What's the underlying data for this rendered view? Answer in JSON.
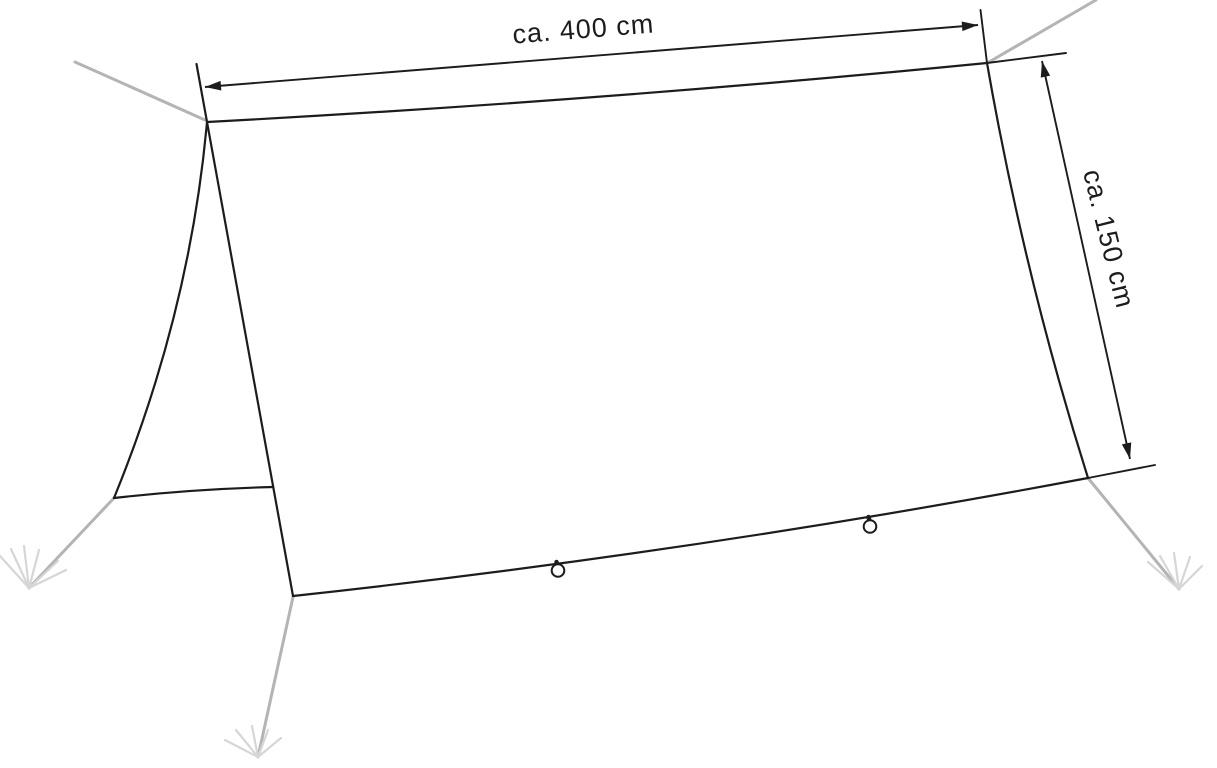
{
  "diagram": {
    "title": "Tarp dimension line drawing",
    "width_dimension": {
      "label": "ca. 400 cm"
    },
    "height_dimension": {
      "label": "ca. 150 cm"
    },
    "colors": {
      "outline": "#1c1c1c",
      "guy_line": "#b4b4b4",
      "stake_mark": "#d6d6d6",
      "background": "#ffffff"
    }
  }
}
